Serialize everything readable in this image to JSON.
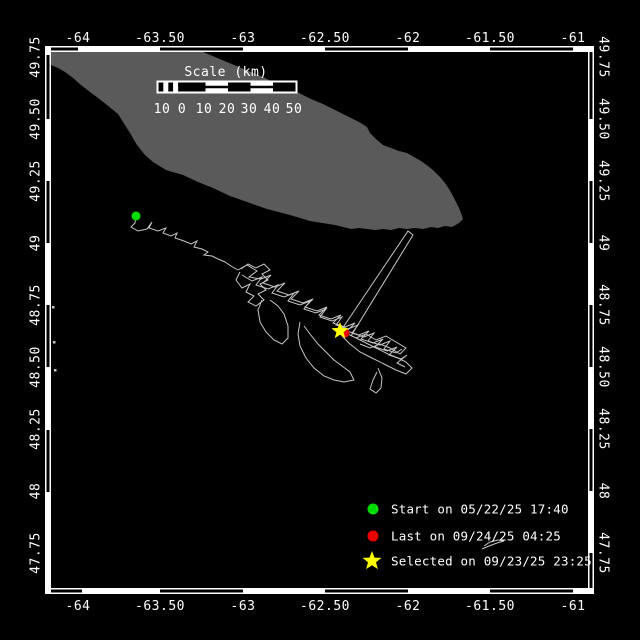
{
  "colors": {
    "background": "#000000",
    "frame": "#ffffff",
    "text": "#ffffff",
    "island": "#5a5a5a",
    "track": "#c6c6c6",
    "start_marker": "#00dc00",
    "last_marker": "#ee0000",
    "selected_marker": "#ffff00"
  },
  "axes": {
    "lon": {
      "labels": [
        {
          "text": "-64",
          "x": 78
        },
        {
          "text": "-63.50",
          "x": 160
        },
        {
          "text": "-63",
          "x": 243
        },
        {
          "text": "-62.50",
          "x": 325
        },
        {
          "text": "-62",
          "x": 408
        },
        {
          "text": "-61.50",
          "x": 490
        },
        {
          "text": "-61",
          "x": 573
        }
      ],
      "top_y": 42,
      "bottom_y": 610
    },
    "lat": {
      "labels": [
        {
          "text": "49.75",
          "y": 57
        },
        {
          "text": "49.50",
          "y": 119
        },
        {
          "text": "49.25",
          "y": 181
        },
        {
          "text": "49",
          "y": 243
        },
        {
          "text": "48.75",
          "y": 305
        },
        {
          "text": "48.50",
          "y": 367
        },
        {
          "text": "48.25",
          "y": 429
        },
        {
          "text": "48",
          "y": 491
        },
        {
          "text": "47.75",
          "y": 553
        }
      ],
      "left_x": 36,
      "right_x": 603
    }
  },
  "frame": {
    "inner": {
      "x0": 51,
      "y0": 52,
      "x1": 588,
      "y1": 588
    },
    "band": 6,
    "top_black": [
      [
        51,
        78
      ],
      [
        160,
        243
      ],
      [
        325,
        408
      ],
      [
        490,
        573
      ]
    ],
    "bottom_black": [
      [
        51,
        82
      ],
      [
        160,
        243
      ],
      [
        325,
        408
      ],
      [
        490,
        573
      ]
    ],
    "left_black": [
      [
        55,
        119
      ],
      [
        181,
        243
      ],
      [
        305,
        367
      ],
      [
        430,
        492
      ]
    ],
    "right_black": [
      [
        52,
        119
      ],
      [
        181,
        243
      ],
      [
        305,
        367
      ],
      [
        429,
        491
      ],
      [
        553,
        588
      ]
    ]
  },
  "scale_bar": {
    "title": "Scale (km)",
    "title_x": 226,
    "title_y": 76,
    "box": {
      "x": 157,
      "y": 81,
      "w": 140,
      "h": 12
    },
    "checker": {
      "x": 158.5,
      "w": 4.9,
      "n": 5
    },
    "cells": [
      {
        "x": 183,
        "w": 22.5,
        "style": "black"
      },
      {
        "x": 205.5,
        "w": 22.5,
        "style": "line"
      },
      {
        "x": 228,
        "w": 22.5,
        "style": "black"
      },
      {
        "x": 250.5,
        "w": 22.5,
        "style": "line"
      },
      {
        "x": 273,
        "w": 22.5,
        "style": "black"
      }
    ],
    "labels": [
      {
        "text": "10",
        "x": 162
      },
      {
        "text": "0",
        "x": 182
      },
      {
        "text": "10",
        "x": 204
      },
      {
        "text": "20",
        "x": 227
      },
      {
        "text": "30",
        "x": 249
      },
      {
        "text": "40",
        "x": 272
      },
      {
        "text": "50",
        "x": 294
      }
    ],
    "labels_y": 113
  },
  "island": {
    "points": [
      [
        51,
        52
      ],
      [
        203,
        52
      ],
      [
        215,
        57
      ],
      [
        227,
        62
      ],
      [
        239,
        67
      ],
      [
        251,
        72
      ],
      [
        263,
        77
      ],
      [
        275,
        83
      ],
      [
        287,
        88
      ],
      [
        299,
        93
      ],
      [
        311,
        99
      ],
      [
        323,
        104
      ],
      [
        335,
        110
      ],
      [
        347,
        116
      ],
      [
        359,
        122
      ],
      [
        367,
        127
      ],
      [
        370,
        133
      ],
      [
        377,
        140
      ],
      [
        383,
        145
      ],
      [
        391,
        148
      ],
      [
        399,
        151
      ],
      [
        407,
        153
      ],
      [
        414,
        157
      ],
      [
        421,
        161
      ],
      [
        428,
        166
      ],
      [
        434,
        171
      ],
      [
        440,
        177
      ],
      [
        445,
        183
      ],
      [
        449,
        189
      ],
      [
        453,
        196
      ],
      [
        456,
        202
      ],
      [
        459,
        208
      ],
      [
        461,
        213
      ],
      [
        463,
        219
      ],
      [
        459,
        223
      ],
      [
        452,
        227
      ],
      [
        445,
        226
      ],
      [
        438,
        228
      ],
      [
        431,
        227
      ],
      [
        423,
        229
      ],
      [
        415,
        228
      ],
      [
        407,
        229
      ],
      [
        399,
        228
      ],
      [
        391,
        230
      ],
      [
        383,
        229
      ],
      [
        375,
        230
      ],
      [
        367,
        229
      ],
      [
        359,
        228
      ],
      [
        351,
        229
      ],
      [
        343,
        227
      ],
      [
        335,
        225
      ],
      [
        310,
        221
      ],
      [
        290,
        215
      ],
      [
        267,
        209
      ],
      [
        247,
        202
      ],
      [
        230,
        196
      ],
      [
        213,
        188
      ],
      [
        198,
        182
      ],
      [
        183,
        175
      ],
      [
        166,
        170
      ],
      [
        153,
        162
      ],
      [
        145,
        155
      ],
      [
        137,
        145
      ],
      [
        130,
        133
      ],
      [
        123,
        122
      ],
      [
        118,
        114
      ],
      [
        107,
        105
      ],
      [
        98,
        98
      ],
      [
        90,
        92
      ],
      [
        81,
        85
      ],
      [
        73,
        78
      ],
      [
        65,
        72
      ],
      [
        58,
        68
      ],
      [
        51,
        65
      ]
    ]
  },
  "tracks": {
    "paths": [
      [
        [
          136,
          216
        ],
        [
          135,
          223
        ],
        [
          131,
          227
        ],
        [
          138,
          231
        ],
        [
          147,
          229
        ],
        [
          152,
          222
        ],
        [
          149,
          228
        ],
        [
          158,
          231
        ],
        [
          166,
          228
        ],
        [
          163,
          233
        ],
        [
          171,
          236
        ],
        [
          177,
          233
        ],
        [
          175,
          238
        ],
        [
          184,
          241
        ],
        [
          191,
          244
        ],
        [
          197,
          241
        ],
        [
          194,
          247
        ],
        [
          202,
          249
        ],
        [
          208,
          252
        ],
        [
          204,
          255
        ],
        [
          212,
          256
        ],
        [
          218,
          259
        ],
        [
          225,
          262
        ],
        [
          231,
          266
        ],
        [
          238,
          270
        ]
      ],
      [
        [
          238,
          270
        ],
        [
          247,
          265
        ],
        [
          257,
          271
        ],
        [
          249,
          277
        ],
        [
          261,
          279
        ],
        [
          271,
          275
        ],
        [
          263,
          283
        ],
        [
          275,
          287
        ],
        [
          285,
          283
        ],
        [
          277,
          291
        ],
        [
          289,
          295
        ],
        [
          299,
          291
        ],
        [
          291,
          299
        ],
        [
          303,
          303
        ],
        [
          313,
          299
        ],
        [
          305,
          307
        ],
        [
          317,
          311
        ],
        [
          327,
          307
        ],
        [
          319,
          315
        ],
        [
          331,
          319
        ],
        [
          341,
          315
        ],
        [
          333,
          323
        ],
        [
          345,
          327
        ],
        [
          355,
          323
        ],
        [
          347,
          331
        ],
        [
          359,
          335
        ],
        [
          369,
          331
        ],
        [
          361,
          339
        ],
        [
          373,
          343
        ],
        [
          383,
          339
        ],
        [
          375,
          347
        ],
        [
          387,
          351
        ],
        [
          397,
          347
        ],
        [
          389,
          355
        ],
        [
          401,
          359
        ],
        [
          407,
          355
        ],
        [
          397,
          363
        ],
        [
          405,
          367
        ]
      ],
      [
        [
          242,
          275
        ],
        [
          252,
          281
        ],
        [
          262,
          277
        ],
        [
          256,
          285
        ],
        [
          268,
          289
        ],
        [
          278,
          285
        ],
        [
          272,
          293
        ],
        [
          284,
          297
        ],
        [
          294,
          293
        ],
        [
          288,
          301
        ],
        [
          300,
          305
        ],
        [
          310,
          301
        ],
        [
          304,
          309
        ],
        [
          316,
          313
        ],
        [
          326,
          309
        ],
        [
          320,
          317
        ],
        [
          332,
          321
        ],
        [
          342,
          317
        ],
        [
          336,
          325
        ],
        [
          348,
          329
        ],
        [
          358,
          325
        ],
        [
          352,
          333
        ],
        [
          364,
          337
        ],
        [
          374,
          333
        ],
        [
          368,
          341
        ],
        [
          380,
          345
        ],
        [
          390,
          341
        ],
        [
          384,
          349
        ],
        [
          396,
          353
        ],
        [
          402,
          349
        ]
      ],
      [
        [
          240,
          272
        ],
        [
          236,
          280
        ],
        [
          242,
          288
        ],
        [
          250,
          284
        ],
        [
          246,
          292
        ],
        [
          254,
          296
        ],
        [
          248,
          302
        ],
        [
          256,
          306
        ],
        [
          264,
          300
        ],
        [
          258,
          294
        ],
        [
          266,
          290
        ],
        [
          260,
          284
        ],
        [
          268,
          280
        ],
        [
          262,
          274
        ],
        [
          270,
          270
        ],
        [
          264,
          264
        ],
        [
          256,
          268
        ],
        [
          248,
          264
        ],
        [
          241,
          269
        ]
      ],
      [
        [
          262,
          300
        ],
        [
          258,
          310
        ],
        [
          260,
          322
        ],
        [
          266,
          332
        ],
        [
          274,
          340
        ],
        [
          282,
          344
        ],
        [
          288,
          338
        ],
        [
          288,
          326
        ],
        [
          284,
          314
        ],
        [
          278,
          306
        ],
        [
          270,
          300
        ]
      ],
      [
        [
          300,
          322
        ],
        [
          298,
          334
        ],
        [
          300,
          346
        ],
        [
          306,
          358
        ],
        [
          314,
          368
        ],
        [
          324,
          376
        ],
        [
          334,
          380
        ],
        [
          344,
          382
        ],
        [
          354,
          380
        ],
        [
          350,
          372
        ],
        [
          342,
          366
        ],
        [
          334,
          360
        ],
        [
          326,
          352
        ],
        [
          318,
          344
        ],
        [
          310,
          334
        ],
        [
          304,
          326
        ]
      ],
      [
        [
          340,
          330
        ],
        [
          352,
          336
        ],
        [
          364,
          342
        ],
        [
          376,
          348
        ],
        [
          388,
          354
        ],
        [
          398,
          358
        ],
        [
          406,
          362
        ],
        [
          412,
          368
        ],
        [
          406,
          374
        ],
        [
          396,
          370
        ],
        [
          384,
          364
        ],
        [
          372,
          358
        ],
        [
          360,
          352
        ],
        [
          350,
          344
        ],
        [
          342,
          336
        ]
      ],
      [
        [
          356,
          338
        ],
        [
          366,
          334
        ],
        [
          376,
          340
        ],
        [
          386,
          336
        ],
        [
          396,
          342
        ],
        [
          406,
          348
        ],
        [
          400,
          354
        ],
        [
          390,
          348
        ],
        [
          380,
          344
        ],
        [
          370,
          348
        ],
        [
          360,
          344
        ]
      ],
      [
        [
          378,
          368
        ],
        [
          382,
          378
        ],
        [
          381,
          388
        ],
        [
          376,
          393
        ],
        [
          370,
          389
        ],
        [
          373,
          380
        ],
        [
          377,
          372
        ]
      ],
      [
        [
          342,
          329
        ],
        [
          408,
          231
        ],
        [
          413,
          235
        ],
        [
          351,
          336
        ]
      ],
      [
        [
          482,
          549
        ],
        [
          489,
          546
        ],
        [
          497,
          543
        ],
        [
          504,
          541
        ],
        [
          498,
          540
        ],
        [
          490,
          542
        ],
        [
          484,
          546
        ]
      ]
    ],
    "fragments": [
      [
        52,
        306
      ],
      [
        53,
        341
      ],
      [
        54,
        369
      ]
    ]
  },
  "markers": {
    "last": {
      "shape": "circle",
      "x": 345,
      "y": 333,
      "r": 4.5
    },
    "selected": {
      "shape": "star",
      "x": 340,
      "y": 331,
      "r": 9
    },
    "start": {
      "shape": "circle",
      "x": 136,
      "y": 216,
      "r": 4.5
    }
  },
  "legend": {
    "marker_x": 373,
    "text_x": 391,
    "items": [
      {
        "shape": "circle",
        "color_key": "start_marker",
        "y": 509,
        "label": "Start on 05/22/25 17:40"
      },
      {
        "shape": "circle",
        "color_key": "last_marker",
        "y": 536,
        "label": "Last on 09/24/25 04:25"
      },
      {
        "shape": "star",
        "color_key": "selected_marker",
        "y": 561,
        "label": "Selected on 09/23/25 23:25"
      }
    ]
  }
}
